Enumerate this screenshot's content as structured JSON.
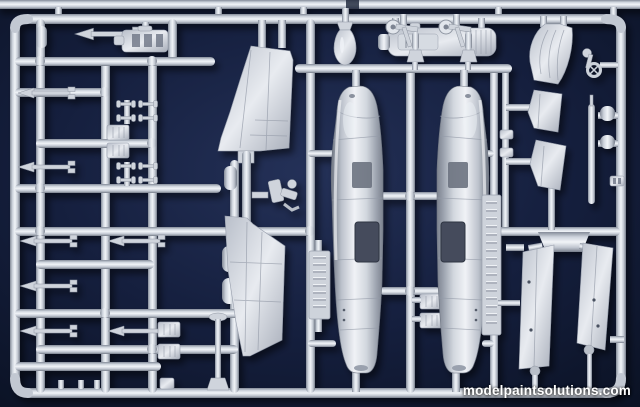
{
  "photo": {
    "subject": "injection-molded plastic model aircraft sprue photographed on dark blue cloth",
    "watermark": {
      "text": "modelpaintsolutions.com"
    },
    "colors": {
      "background": "#101831",
      "background_center": "#1e2a52",
      "background_edge": "#0a1122",
      "plastic": "#c9cfd8",
      "plastic_highlight": "#f0f3f7",
      "plastic_shadow": "#7b8290",
      "metal": "#dfe3e9",
      "recess": "#424a5a",
      "watermark_color": "#ffffff"
    },
    "parts": [
      "top-runner",
      "sprue-frame",
      "parts-grid",
      "receiver-part",
      "dart-parts",
      "dumbbell-parts",
      "box-parts",
      "vertical-fin",
      "lower-fin",
      "ejection-seat",
      "stand-part",
      "fuselage-half-left",
      "fuselage-half-right",
      "engine-cover",
      "bomb",
      "landing-gear-left",
      "landing-gear-right",
      "rudder",
      "stabilizer-upper",
      "stabilizer-lower",
      "control-yoke",
      "pitot-blade",
      "flap-left",
      "flap-right",
      "embossed-tag-left",
      "embossed-tag-right"
    ]
  }
}
